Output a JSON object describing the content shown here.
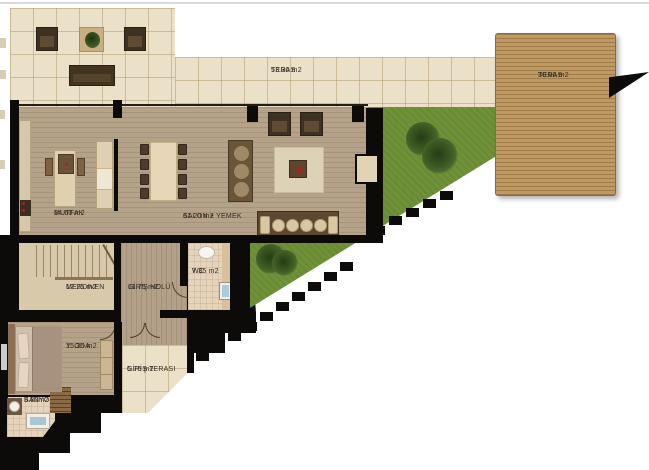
{
  "plan": {
    "type": "architectural floor plan",
    "rooms": [
      {
        "id": "teras-upper",
        "name": "TERAS",
        "area": "53.30 m2"
      },
      {
        "id": "teras-deck",
        "name": "TERAS",
        "area": "30.00 m2"
      },
      {
        "id": "mutfak",
        "name": "MUTFAK",
        "area": "24.60 m2"
      },
      {
        "id": "salon-yemek",
        "name": "SALON + YEMEK",
        "area": "61.20 m2"
      },
      {
        "id": "merdiven",
        "name": "MERDIVEN",
        "area": "12.25 m2"
      },
      {
        "id": "giris-holu",
        "name": "GİRİŞ HOLÜ",
        "area": "11.75 m2"
      },
      {
        "id": "wc",
        "name": "WC",
        "area": "7.35 m2"
      },
      {
        "id": "yatak-odasi",
        "name": "Y. ODA",
        "area": "15.35 m2"
      },
      {
        "id": "giris-terasi",
        "name": "GİRİŞ TERASI",
        "area": "5.76 m2"
      },
      {
        "id": "banyo",
        "name": "BANYO",
        "area": "5.80m2"
      }
    ],
    "colors": {
      "wall": "#0d0b09",
      "tile": "#ebe1c8",
      "wood_floor": "#b4a289",
      "deck_wood": "#c19a62",
      "grass": "#6f9138",
      "label_text": "#332d24"
    }
  }
}
